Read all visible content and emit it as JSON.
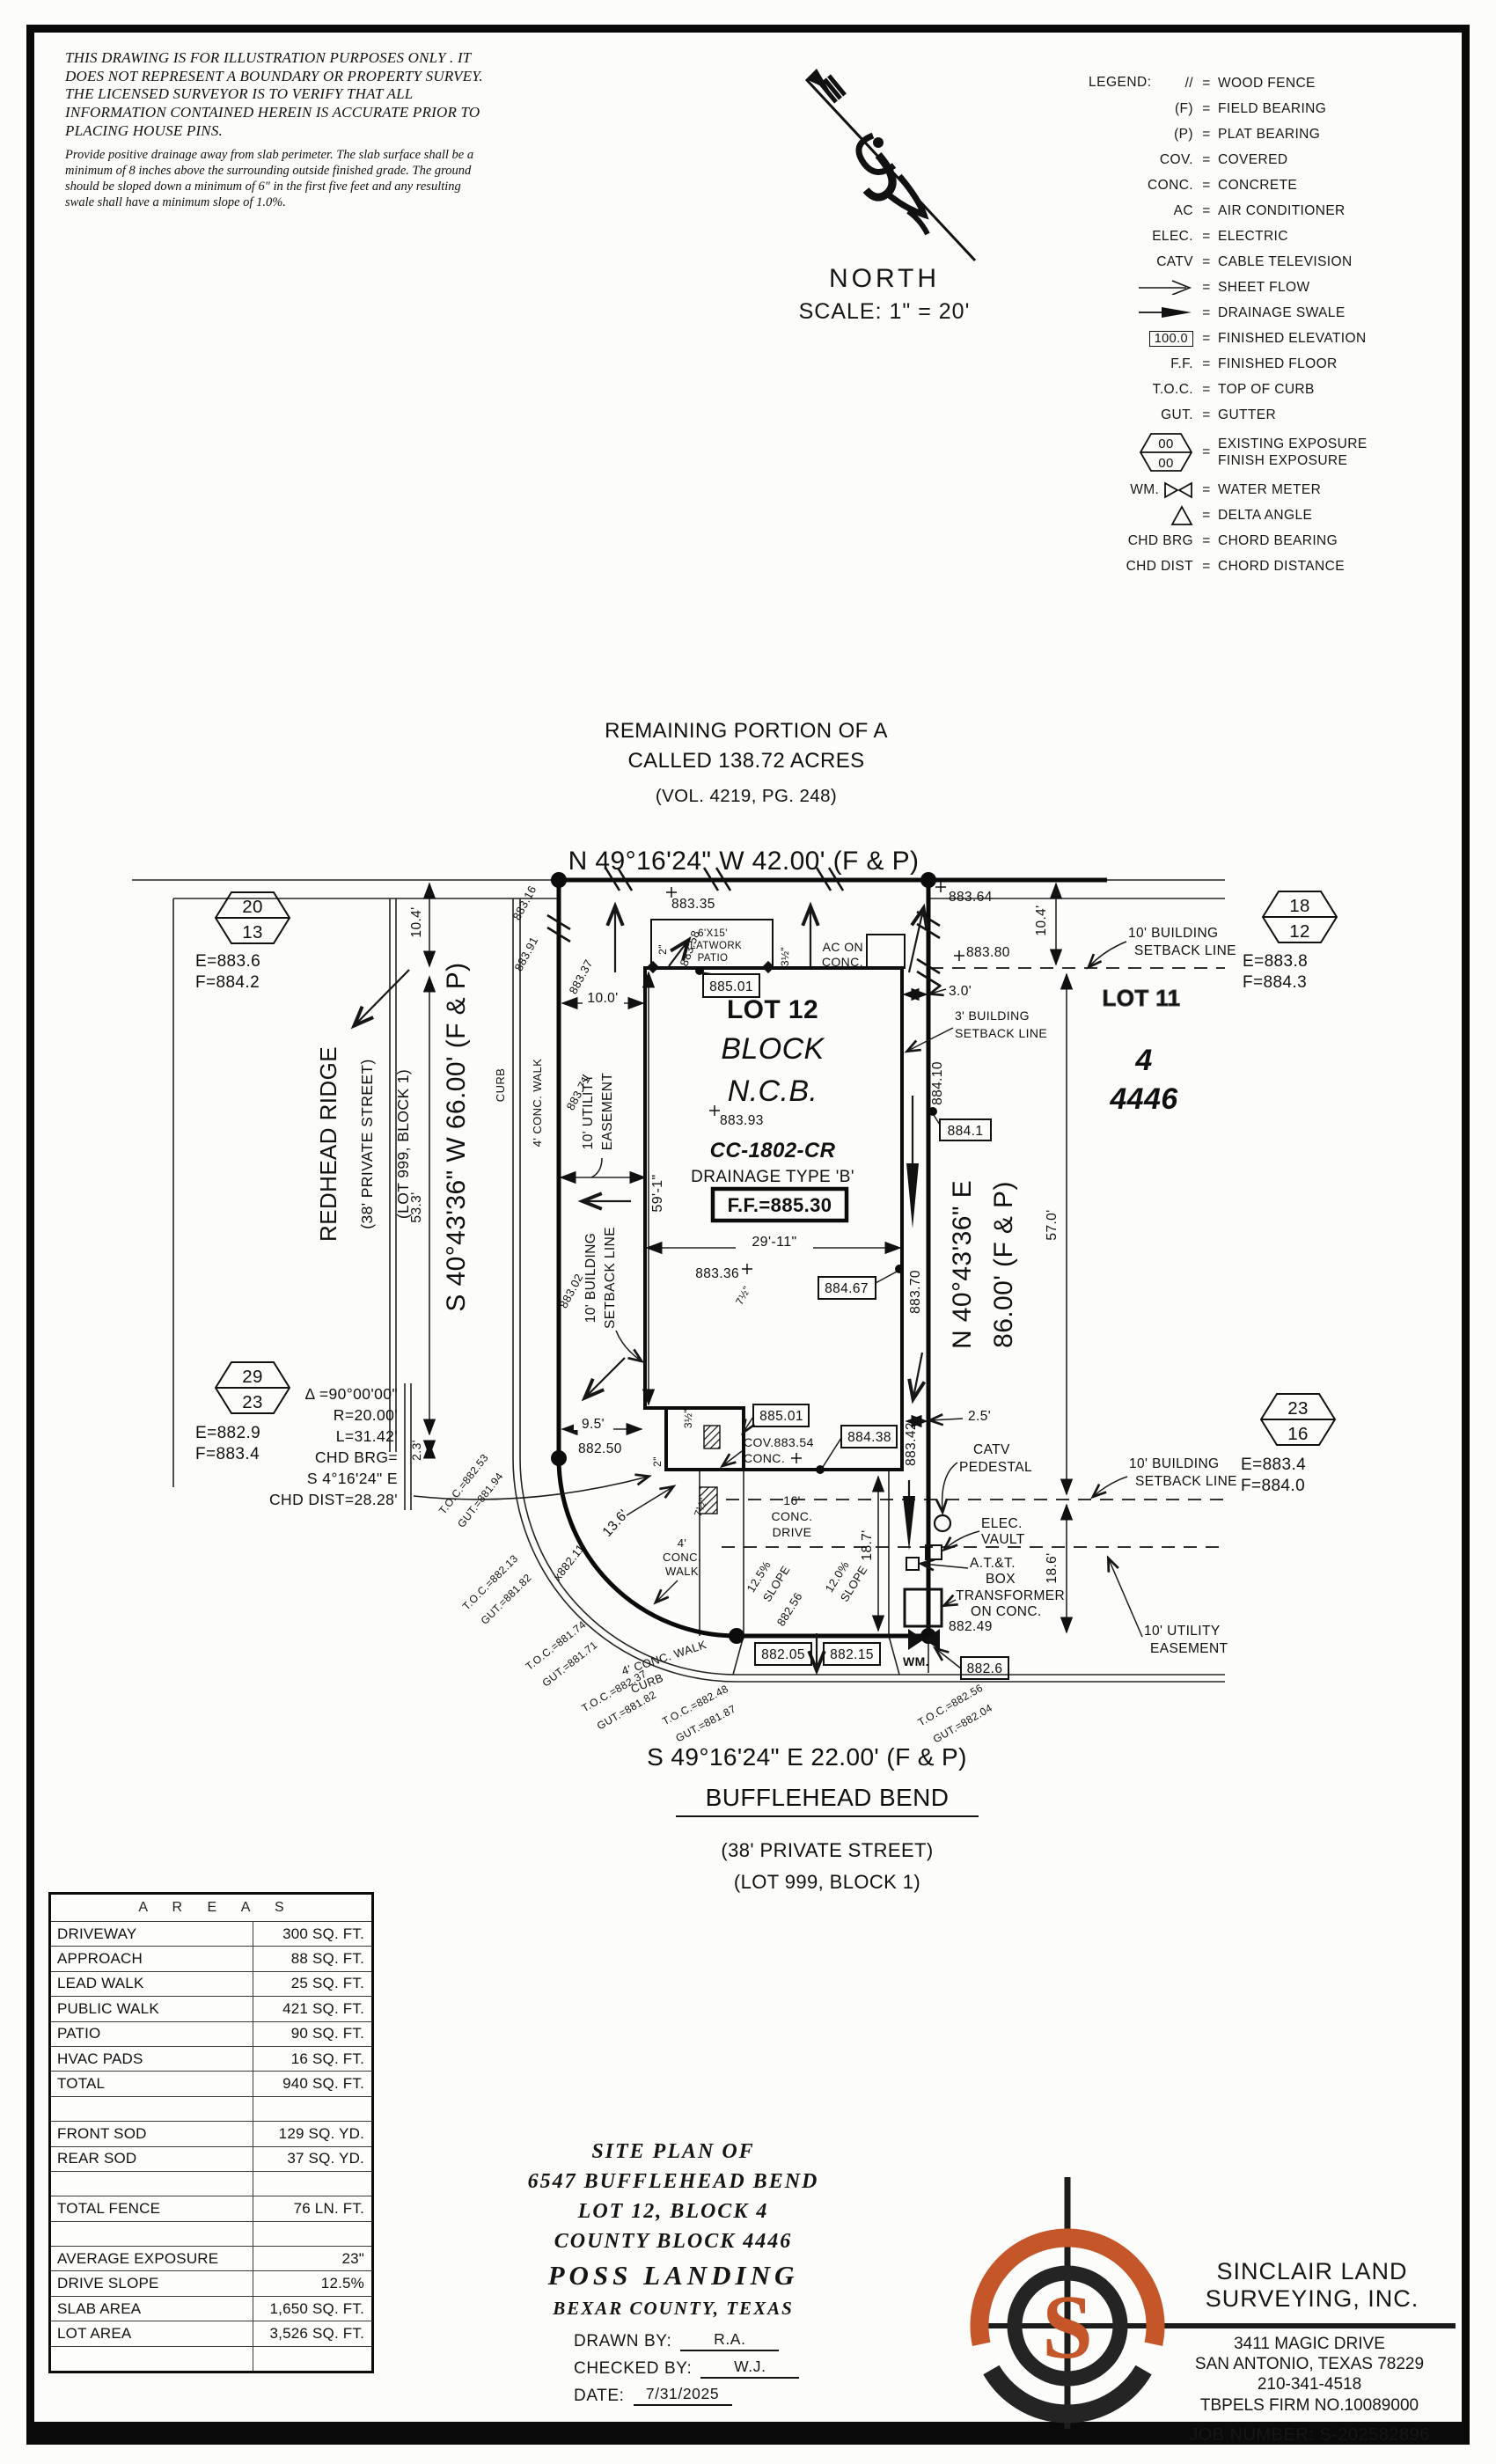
{
  "colors": {
    "logo_orange": "#c4562a",
    "ink": "#111111",
    "paper": "#fcfcfa"
  },
  "disclaimer": {
    "para1": "THIS DRAWING IS FOR ILLUSTRATION PURPOSES ONLY . IT DOES NOT REPRESENT A BOUNDARY OR PROPERTY SURVEY. THE LICENSED SURVEYOR IS TO VERIFY THAT ALL INFORMATION CONTAINED HEREIN IS ACCURATE PRIOR TO PLACING HOUSE PINS.",
    "para2": "Provide positive drainage away from slab perimeter. The slab surface shall be a minimum of 8 inches above the surrounding outside finished grade. The ground should be sloped down a minimum of 6\" in the first five feet and any resulting swale shall have a minimum slope of 1.0%."
  },
  "north": {
    "label": "NORTH",
    "scale": "SCALE: 1\" = 20'"
  },
  "legend": {
    "title": "LEGEND:",
    "items": [
      {
        "symbol": "//",
        "label": "WOOD FENCE"
      },
      {
        "symbol": "(F)",
        "label": "FIELD BEARING"
      },
      {
        "symbol": "(P)",
        "label": "PLAT BEARING"
      },
      {
        "symbol": "COV.",
        "label": "COVERED"
      },
      {
        "symbol": "CONC.",
        "label": "CONCRETE"
      },
      {
        "symbol": "AC",
        "label": "AIR CONDITIONER"
      },
      {
        "symbol": "ELEC.",
        "label": "ELECTRIC"
      },
      {
        "symbol": "CATV",
        "label": "CABLE TELEVISION"
      },
      {
        "symbol": "",
        "label": "SHEET FLOW"
      },
      {
        "symbol": "",
        "label": "DRAINAGE SWALE"
      },
      {
        "symbol": "100.0",
        "label": "FINISHED ELEVATION"
      },
      {
        "symbol": "F.F.",
        "label": "FINISHED FLOOR"
      },
      {
        "symbol": "T.O.C.",
        "label": "TOP OF CURB"
      },
      {
        "symbol": "GUT.",
        "label": "GUTTER"
      },
      {
        "s1": "00",
        "s2": "00",
        "label": "EXISTING EXPOSURE",
        "label2": "FINISH EXPOSURE"
      },
      {
        "symbol": "WM.",
        "label": "WATER METER"
      },
      {
        "symbol": "",
        "label": "DELTA ANGLE"
      },
      {
        "symbol": "CHD BRG",
        "label": "CHORD BEARING"
      },
      {
        "symbol": "CHD DIST",
        "label": "CHORD DISTANCE"
      }
    ]
  },
  "plan": {
    "header": {
      "rem1": "REMAINING PORTION OF A",
      "rem2": "CALLED 138.72 ACRES",
      "rem3": "(VOL. 4219, PG. 248)",
      "bearing_north": "N 49°16'24\" W  42.00' (F & P)"
    },
    "streets": {
      "redhead": "REDHEAD RIDGE",
      "rr_sub1": "(38' PRIVATE STREET)",
      "rr_sub2": "(LOT 999, BLOCK 1)",
      "bearing_west": "S 40°43'36\" W  66.00' (F & P)",
      "bearing_east1": "N 40°43'36\" E",
      "bearing_east2": "86.00' (F & P)",
      "bearing_south": "S 49°16'24\" E  22.00' (F & P)",
      "bufflehead": "BUFFLEHEAD BEND",
      "bb_sub1": "(38' PRIVATE STREET)",
      "bb_sub2": "(LOT 999, BLOCK 1)"
    },
    "lot": {
      "lot12": "LOT 12",
      "block": "BLOCK",
      "ncb": "N.C.B.",
      "cc": "CC-1802-CR",
      "drainage": "DRAINAGE TYPE 'B'",
      "ff": "F.F.=885.30"
    },
    "lot11": {
      "name": "LOT 11",
      "block": "4",
      "ncb": "4446"
    },
    "hex": [
      {
        "top": "20",
        "bottom": "13",
        "e": "E=883.6",
        "f": "F=884.2"
      },
      {
        "top": "18",
        "bottom": "12",
        "e": "E=883.8",
        "f": "F=884.3"
      },
      {
        "top": "29",
        "bottom": "23",
        "e": "E=882.9",
        "f": "F=883.4"
      },
      {
        "top": "23",
        "bottom": "16",
        "e": "E=883.4",
        "f": "F=884.0"
      }
    ],
    "curve": {
      "delta": "Δ =90°00'00\"",
      "r": "R=20.00'",
      "l": "L=31.42'",
      "chd1": "CHD BRG=",
      "chd2": "S 4°16'24\" E",
      "chd3": "CHD DIST=28.28'"
    },
    "dims": {
      "d104l": "10.4'",
      "d533": "53.3'",
      "d23": "2.3'",
      "d104r": "10.4'",
      "d570": "57.0'",
      "d186": "18.6'",
      "d187": "18.7'",
      "d100": "10.0'",
      "d30": "3.0'",
      "d95": "9.5'",
      "d25": "2.5'",
      "d136": "13.6'",
      "d5901": "59'-1\"",
      "d2911": "29'-11\"",
      "d2a": "2\"",
      "d35a": "3½\"",
      "d35b": "3½\"",
      "d2b": "2\"",
      "d75a": "7½\"",
      "d75b": "7½\""
    },
    "elev": {
      "e88335": "883.35",
      "e88364": "883.64",
      "e88380": "883.80",
      "e88316": "883.16",
      "e88391": "883.91",
      "e88337": "883.37",
      "e88358": "883.58",
      "e88371": "883.71",
      "e88302": "883.02",
      "e88393": "883.93",
      "e88501a": "885.01",
      "e88501b": "885.01",
      "e8841": "884.1",
      "e88410": "884.10",
      "e88467": "884.67",
      "e88370": "883.70",
      "e88336": "883.36",
      "e88250": "882.50",
      "e88342": "883.42",
      "e88438": "884.38",
      "e88354": "COV.883.54",
      "e88256": "882.56",
      "e88205": "882.05",
      "e88215": "882.15",
      "e88249": "882.49",
      "e8826": "882.6",
      "e88211": "x882.11"
    },
    "notes": {
      "bsl10": "10' BUILDING",
      "bsl10b": "SETBACK LINE",
      "bsl3a": "3' BUILDING",
      "bsl3b": "SETBACK LINE",
      "ue10a": "10' UTILITY",
      "ue10b": "EASEMENT",
      "acon1": "AC ON",
      "acon2": "CONC.",
      "patio1": "6'X15'",
      "patio2": "FLATWORK",
      "patio3": "PATIO",
      "drive1": "16'",
      "drive2": "CONC.",
      "drive3": "DRIVE",
      "walk4a": "4'",
      "walk4b": "CONC.",
      "walk4c": "WALK",
      "walk4": "4' CONC. WALK",
      "curb": "CURB",
      "catv1": "CATV",
      "catv2": "PEDESTAL",
      "elec1": "ELEC.",
      "elec2": "VAULT",
      "att1": "A.T.&T.",
      "att2": "BOX",
      "trans1": "TRANSFORMER",
      "trans2": "ON CONC.",
      "wm": "WM.",
      "cov2": "CONC.",
      "plus": "+",
      "slope1a": "12.5%",
      "slope1b": "SLOPE",
      "slope2a": "12.0%",
      "slope2b": "SLOPE"
    },
    "toc": [
      {
        "t": "T.O.C.=882.53",
        "g": "GUT.=881.94"
      },
      {
        "t": "T.O.C.=882.13",
        "g": "GUT.=881.82"
      },
      {
        "t": "T.O.C.=881.74",
        "g": "GUT.=881.71"
      },
      {
        "t": "T.O.C.=882.37",
        "g": "GUT.=881.82"
      },
      {
        "t": "T.O.C.=882.48",
        "g": "GUT.=881.87"
      },
      {
        "t": "T.O.C.=882.56",
        "g": "GUT.=882.04"
      }
    ]
  },
  "areas": {
    "title": "A R E A S",
    "rows": [
      {
        "label": "DRIVEWAY",
        "value": "300 SQ. FT."
      },
      {
        "label": "APPROACH",
        "value": "88 SQ. FT."
      },
      {
        "label": "LEAD WALK",
        "value": "25 SQ. FT."
      },
      {
        "label": "PUBLIC WALK",
        "value": "421 SQ. FT."
      },
      {
        "label": "PATIO",
        "value": "90 SQ. FT."
      },
      {
        "label": "HVAC PADS",
        "value": "16 SQ. FT."
      },
      {
        "label": "TOTAL",
        "value": "940 SQ. FT."
      },
      {
        "label": "",
        "value": ""
      },
      {
        "label": "FRONT SOD",
        "value": "129 SQ. YD."
      },
      {
        "label": "REAR SOD",
        "value": "37 SQ. YD."
      },
      {
        "label": "",
        "value": ""
      },
      {
        "label": "TOTAL FENCE",
        "value": "76 LN. FT."
      },
      {
        "label": "",
        "value": ""
      },
      {
        "label": "AVERAGE EXPOSURE",
        "value": "23\""
      },
      {
        "label": "DRIVE SLOPE",
        "value": "12.5%"
      },
      {
        "label": "SLAB AREA",
        "value": "1,650 SQ. FT."
      },
      {
        "label": "LOT AREA",
        "value": "3,526 SQ. FT."
      },
      {
        "label": "",
        "value": ""
      }
    ]
  },
  "title_block": {
    "l1": "SITE PLAN OF",
    "l2": "6547 BUFFLEHEAD BEND",
    "l3": "LOT 12, BLOCK 4",
    "l4": "COUNTY BLOCK 4446",
    "l5": "POSS LANDING",
    "l6": "BEXAR COUNTY, TEXAS",
    "drawn_label": "DRAWN BY:",
    "drawn_value": "R.A.",
    "checked_label": "CHECKED BY:",
    "checked_value": "W.J.",
    "date_label": "DATE:",
    "date_value": "7/31/2025"
  },
  "firm": {
    "name1": "SINCLAIR LAND",
    "name2": "SURVEYING, INC.",
    "addr1": "3411 MAGIC DRIVE",
    "addr2": "SAN ANTONIO, TEXAS 78229",
    "phone": "210-341-4518",
    "firmno": "TBPELS FIRM NO.10089000",
    "job": "JOB NUMBER:  S-202582896",
    "logo_letter": "S"
  }
}
